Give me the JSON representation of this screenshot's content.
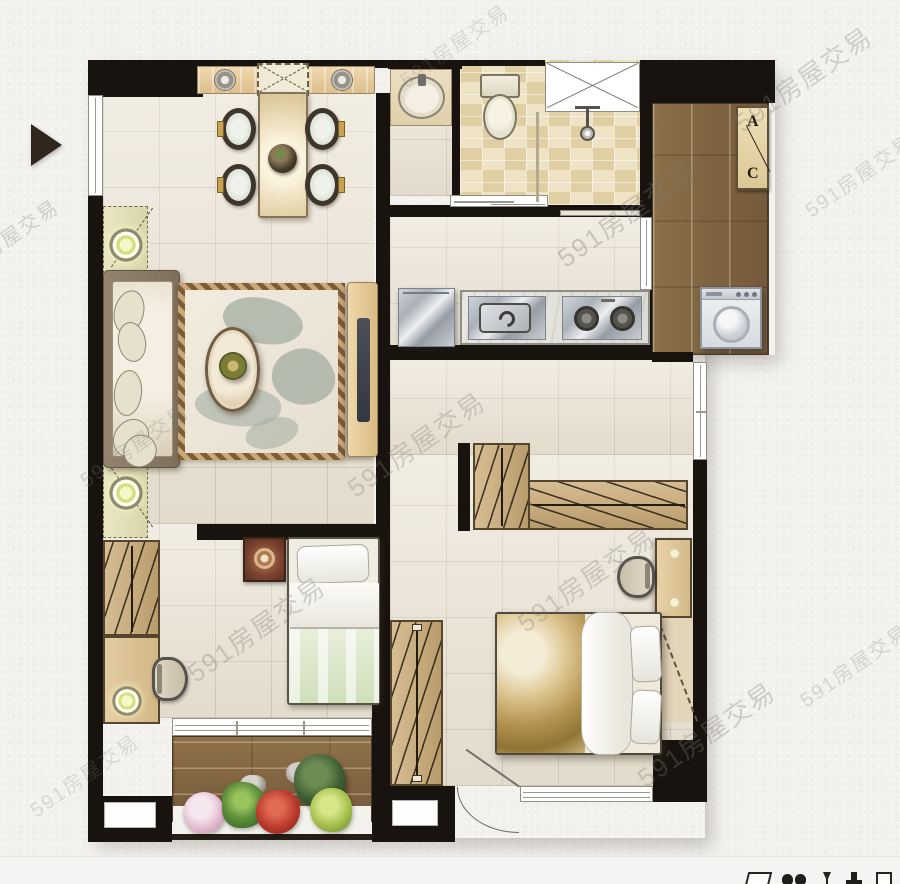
{
  "watermark": {
    "text": "591房屋交易"
  },
  "ac_unit_label": {
    "top": "A",
    "bottom": "C"
  },
  "palette": {
    "wall": "#18130e",
    "floor_tile": "#eae3d4",
    "bath_tile": "#e7d9b3",
    "wood_dark": "#85693f",
    "wood_light": "#cbb084",
    "plant_pink": "#e5c3d3",
    "plant_red": "#bb3a2c",
    "plant_green": "#5d8f3b",
    "entrance_marker": "#32251d"
  }
}
